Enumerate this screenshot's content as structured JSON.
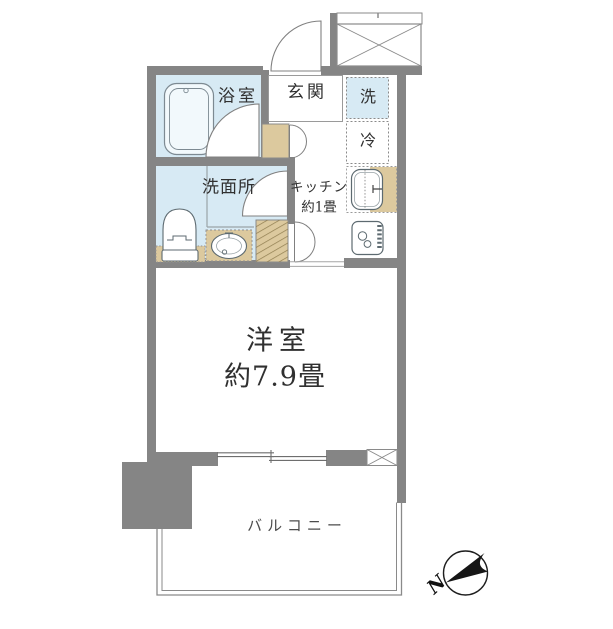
{
  "rooms": {
    "bathroom": "浴室",
    "entrance": "玄関",
    "washer": "洗",
    "fridge": "冷",
    "kitchen_line1": "キッチン",
    "kitchen_line2": "約1畳",
    "washroom": "洗面所",
    "main_room_line1": "洋室",
    "main_room_line2": "約7.9畳",
    "balcony": "バルコニー"
  },
  "compass": {
    "north_label": "N"
  },
  "colors": {
    "wall": "#858585",
    "wet_area_floor": "#d7eaf4",
    "fixture_beige": "#dcc99e",
    "outline": "#8a8a8a",
    "text": "#303030"
  }
}
